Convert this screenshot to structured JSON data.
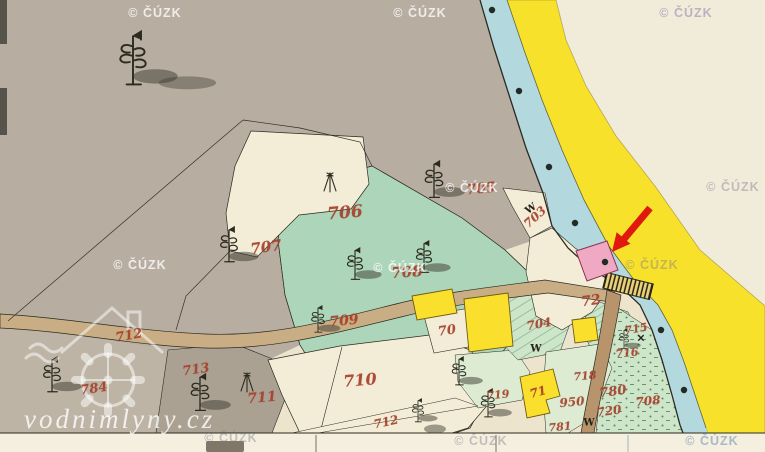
{
  "meta": {
    "kind": "antique cadastral map scan (water-mill site highlighted)",
    "canvas": {
      "width": 765,
      "height": 452
    }
  },
  "watermarks": {
    "cuzk_text": "© ČÚZK",
    "cuzk_positions": [
      {
        "x": 155,
        "y": 13,
        "tone": "light"
      },
      {
        "x": 420,
        "y": 13,
        "tone": "light"
      },
      {
        "x": 686,
        "y": 13,
        "tone": "faint-purple"
      },
      {
        "x": 472,
        "y": 188,
        "tone": "light"
      },
      {
        "x": 733,
        "y": 187,
        "tone": "faint"
      },
      {
        "x": 140,
        "y": 265,
        "tone": "light"
      },
      {
        "x": 400,
        "y": 268,
        "tone": "light"
      },
      {
        "x": 652,
        "y": 265,
        "tone": "faint"
      },
      {
        "x": 231,
        "y": 438,
        "tone": "faint"
      },
      {
        "x": 481,
        "y": 441,
        "tone": "faint"
      },
      {
        "x": 712,
        "y": 441,
        "tone": "faint-blue"
      }
    ],
    "vodnimlyny_text": "vodnimlyny.cz"
  },
  "map": {
    "parcel_labels": [
      {
        "text": "706",
        "x": 345,
        "y": 213,
        "rot": -5,
        "size": 17
      },
      {
        "text": "705",
        "x": 481,
        "y": 189,
        "rot": -6,
        "size": 14
      },
      {
        "text": "707",
        "x": 266,
        "y": 247,
        "rot": -8,
        "size": 15
      },
      {
        "text": "708",
        "x": 407,
        "y": 272,
        "rot": -4,
        "size": 15
      },
      {
        "text": "709",
        "x": 344,
        "y": 321,
        "rot": -6,
        "size": 14
      },
      {
        "text": "703",
        "x": 535,
        "y": 217,
        "rot": -42,
        "size": 12
      },
      {
        "text": "70",
        "x": 447,
        "y": 331,
        "rot": -8,
        "size": 13
      },
      {
        "text": "704",
        "x": 539,
        "y": 324,
        "rot": -10,
        "size": 12
      },
      {
        "text": "72",
        "x": 591,
        "y": 301,
        "rot": -8,
        "size": 14
      },
      {
        "text": "712",
        "x": 129,
        "y": 336,
        "rot": -10,
        "size": 13
      },
      {
        "text": "713",
        "x": 196,
        "y": 370,
        "rot": -8,
        "size": 13
      },
      {
        "text": "711",
        "x": 262,
        "y": 398,
        "rot": -5,
        "size": 14
      },
      {
        "text": "710",
        "x": 360,
        "y": 380,
        "rot": -5,
        "size": 16
      },
      {
        "text": "784",
        "x": 94,
        "y": 389,
        "rot": -8,
        "size": 13
      },
      {
        "text": "712",
        "x": 386,
        "y": 422,
        "rot": -12,
        "size": 12
      },
      {
        "text": "719",
        "x": 498,
        "y": 395,
        "rot": -6,
        "size": 11
      },
      {
        "text": "71",
        "x": 538,
        "y": 392,
        "rot": -15,
        "size": 12
      },
      {
        "text": "715",
        "x": 636,
        "y": 329,
        "rot": -10,
        "size": 11
      },
      {
        "text": "716",
        "x": 627,
        "y": 353,
        "rot": -5,
        "size": 11
      },
      {
        "text": "718",
        "x": 585,
        "y": 376,
        "rot": -5,
        "size": 11
      },
      {
        "text": "780",
        "x": 613,
        "y": 392,
        "rot": -8,
        "size": 13
      },
      {
        "text": "708",
        "x": 648,
        "y": 401,
        "rot": -5,
        "size": 12
      },
      {
        "text": "950",
        "x": 572,
        "y": 402,
        "rot": -5,
        "size": 12
      },
      {
        "text": "720",
        "x": 609,
        "y": 411,
        "rot": -8,
        "size": 12
      },
      {
        "text": "781",
        "x": 560,
        "y": 427,
        "rot": -5,
        "size": 11
      }
    ],
    "symbol_marks": [
      {
        "glyph": "W",
        "x": 531,
        "y": 209,
        "rot": -35
      },
      {
        "glyph": "W",
        "x": 536,
        "y": 349,
        "rot": 0
      },
      {
        "glyph": "W",
        "x": 589,
        "y": 423,
        "rot": 0
      },
      {
        "glyph": "✕",
        "x": 641,
        "y": 339,
        "rot": 0
      }
    ],
    "highlight_arrow": {
      "color": "#E0180E",
      "direction": "pointing down-left at pink building"
    },
    "colors": {
      "paper_cream": "#EDE4CE",
      "outside_sheet": "#F1EBDA",
      "margin_strip": "#F4EFDE",
      "upland_grey": "#B7ADA0",
      "lower_grey": "#BEB4A5",
      "dark_grey": "#ABA193",
      "field_cream": "#F3EDD7",
      "meadow_green": "#ADD5B9",
      "meadow_hatch": "#2E6B4C",
      "light_green": "#CDE5C8",
      "pale_green": "#DCEBD2",
      "river_blue": "#B3D8DE",
      "shore_yellow": "#F8E12B",
      "building_yellow": "#FBDF2D",
      "building_pink": "#F0A9C3",
      "road_tan": "#C9AE85",
      "road_brown": "#B7946B",
      "ink": "#2B2B21",
      "parcel_red": "#A8402C",
      "arrow_red": "#E0180E"
    }
  }
}
